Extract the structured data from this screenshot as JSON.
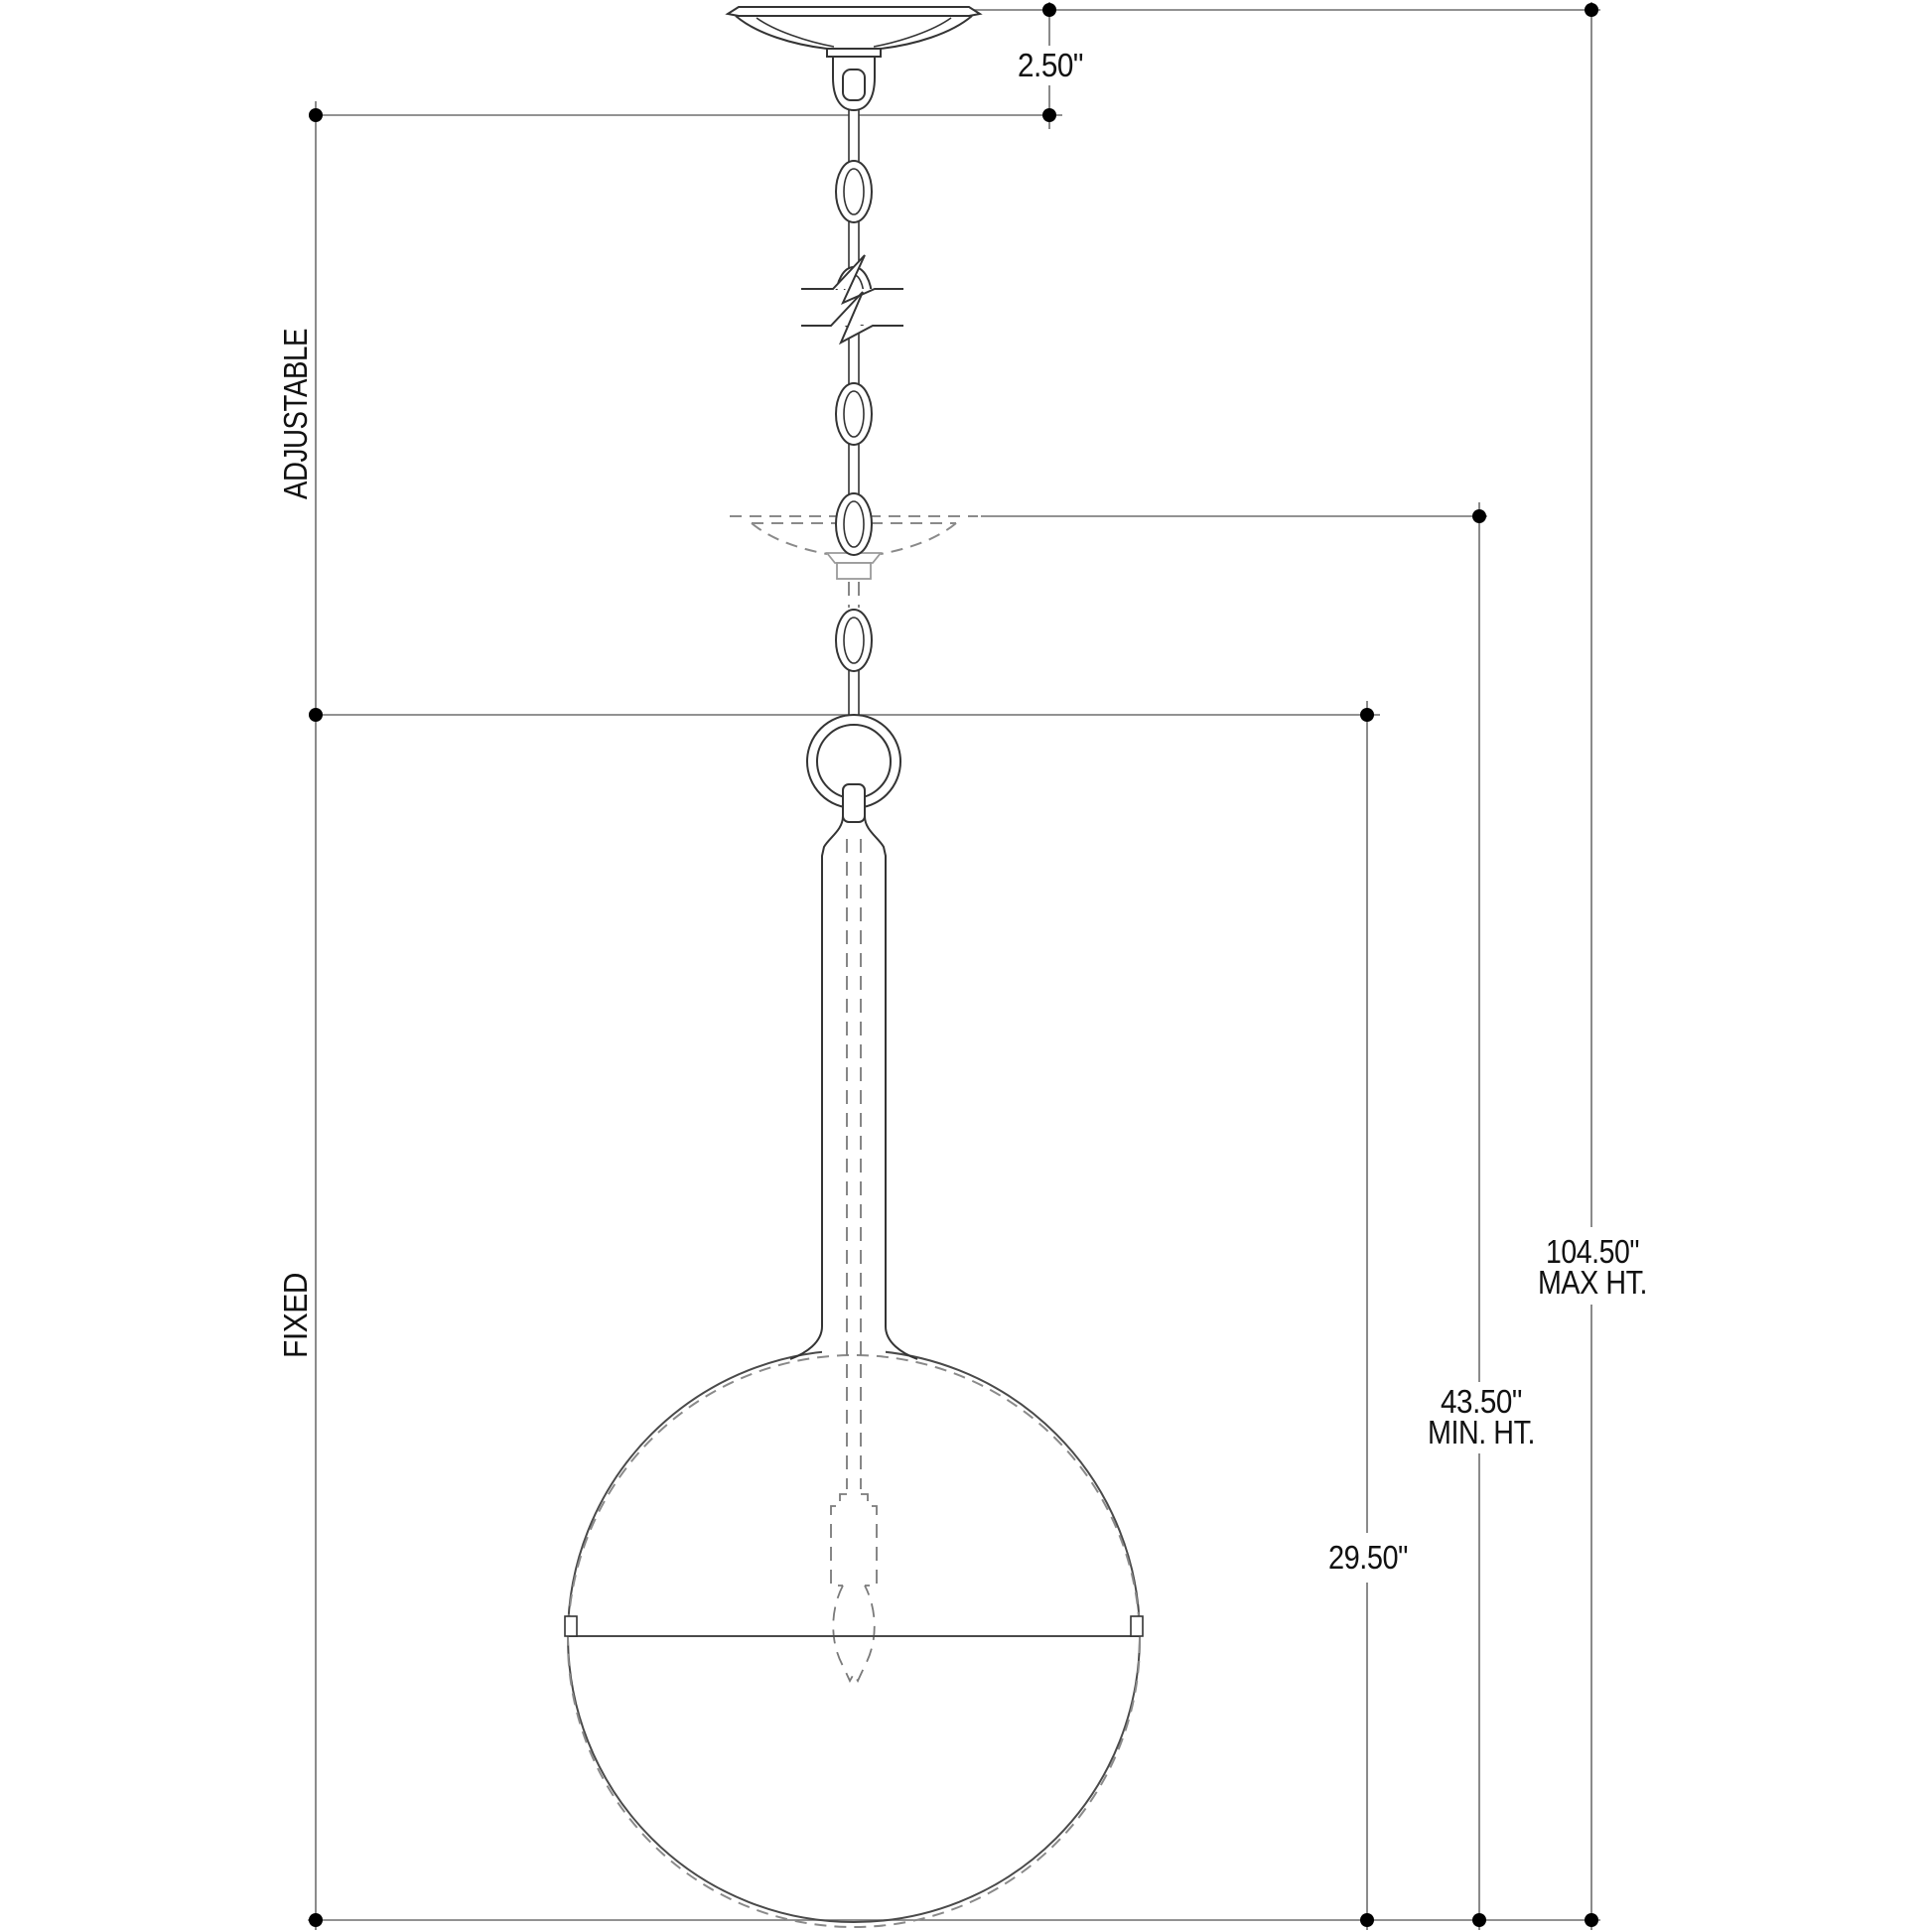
{
  "drawing": {
    "kind": "pendant-light-fixture-dimension-drawing",
    "labels": {
      "canopy_drop": "2.50\"",
      "adjustable": "ADJUSTABLE",
      "fixed": "FIXED",
      "body_height": "29.50\"",
      "min_height_value": "43.50\"",
      "min_height_label": "MIN. HT.",
      "max_height_value": "104.50\"",
      "max_height_label": "MAX HT."
    },
    "colors": {
      "background": "#ffffff",
      "fixture_line": "#343434",
      "dimension_line": "#6e6e6e",
      "ghost_dashed_line": "#8a8a8a",
      "text": "#111111",
      "dimension_dot": "#000000"
    }
  }
}
